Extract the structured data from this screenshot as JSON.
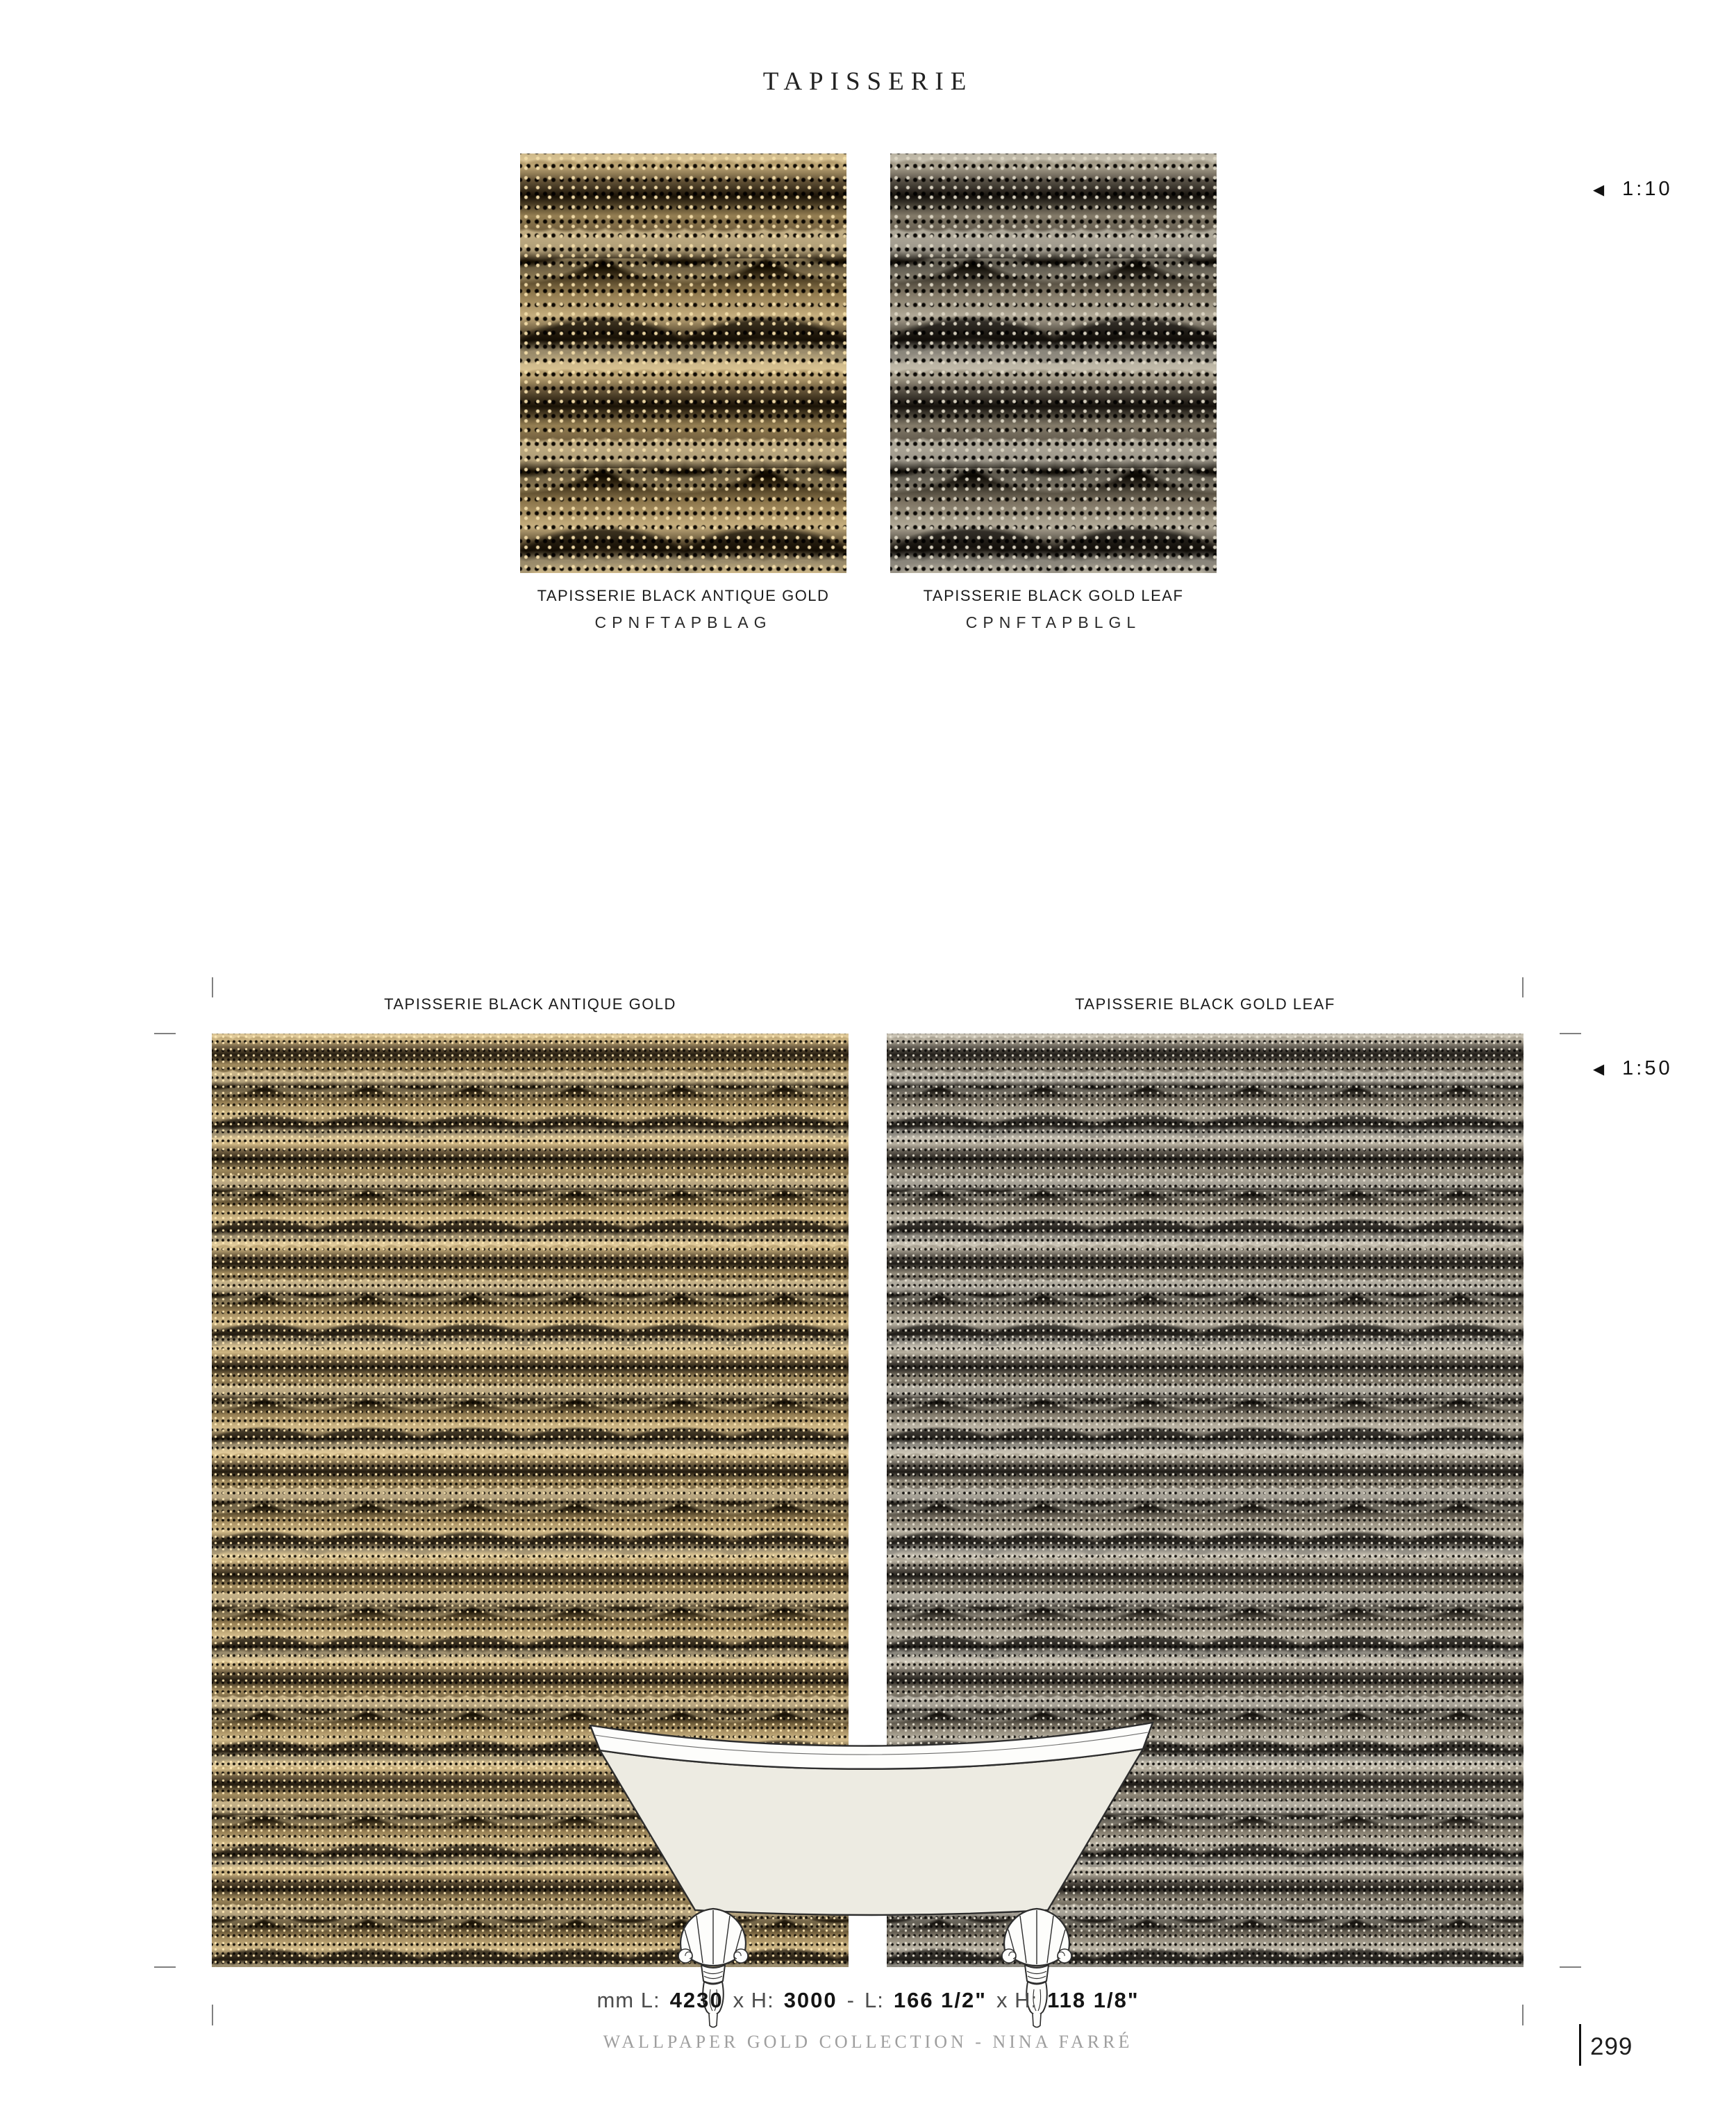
{
  "page": {
    "title": "TAPISSERIE",
    "footer": "WALLPAPER GOLD COLLECTION - NINA FARRÉ",
    "page_number": "299"
  },
  "scale_markers": [
    {
      "icon": "◀",
      "label": "1:10"
    },
    {
      "icon": "◀",
      "label": "1:50"
    }
  ],
  "swatches": [
    {
      "name": "TAPISSERIE BLACK ANTIQUE GOLD",
      "code": "CPNFTAPBLAG"
    },
    {
      "name": "TAPISSERIE BLACK GOLD LEAF",
      "code": "CPNFTAPBLGL"
    }
  ],
  "panels": [
    {
      "label": "TAPISSERIE BLACK ANTIQUE GOLD"
    },
    {
      "label": "TAPISSERIE BLACK GOLD LEAF"
    }
  ],
  "dimensions": {
    "parts": [
      "mm L:",
      "4230",
      "x H:",
      "3000",
      "-",
      "L:",
      "166 1/2\"",
      "x H:",
      "118 1/8\""
    ]
  },
  "colors": {
    "ink": "#1f1f1f",
    "footer_gray": "#9e9e9e",
    "crop_mark_gray": "#808080",
    "wallpaper_gold_light": "#c3b38f",
    "wallpaper_gold_mid": "#8d7b58",
    "wallpaper_brown_dark": "#241d13",
    "wallpaper_black": "#15100a",
    "tub_body_fill": "#edebe2",
    "tub_rim_fill": "#fdfdfb",
    "tub_outline": "#2d2d2d"
  }
}
